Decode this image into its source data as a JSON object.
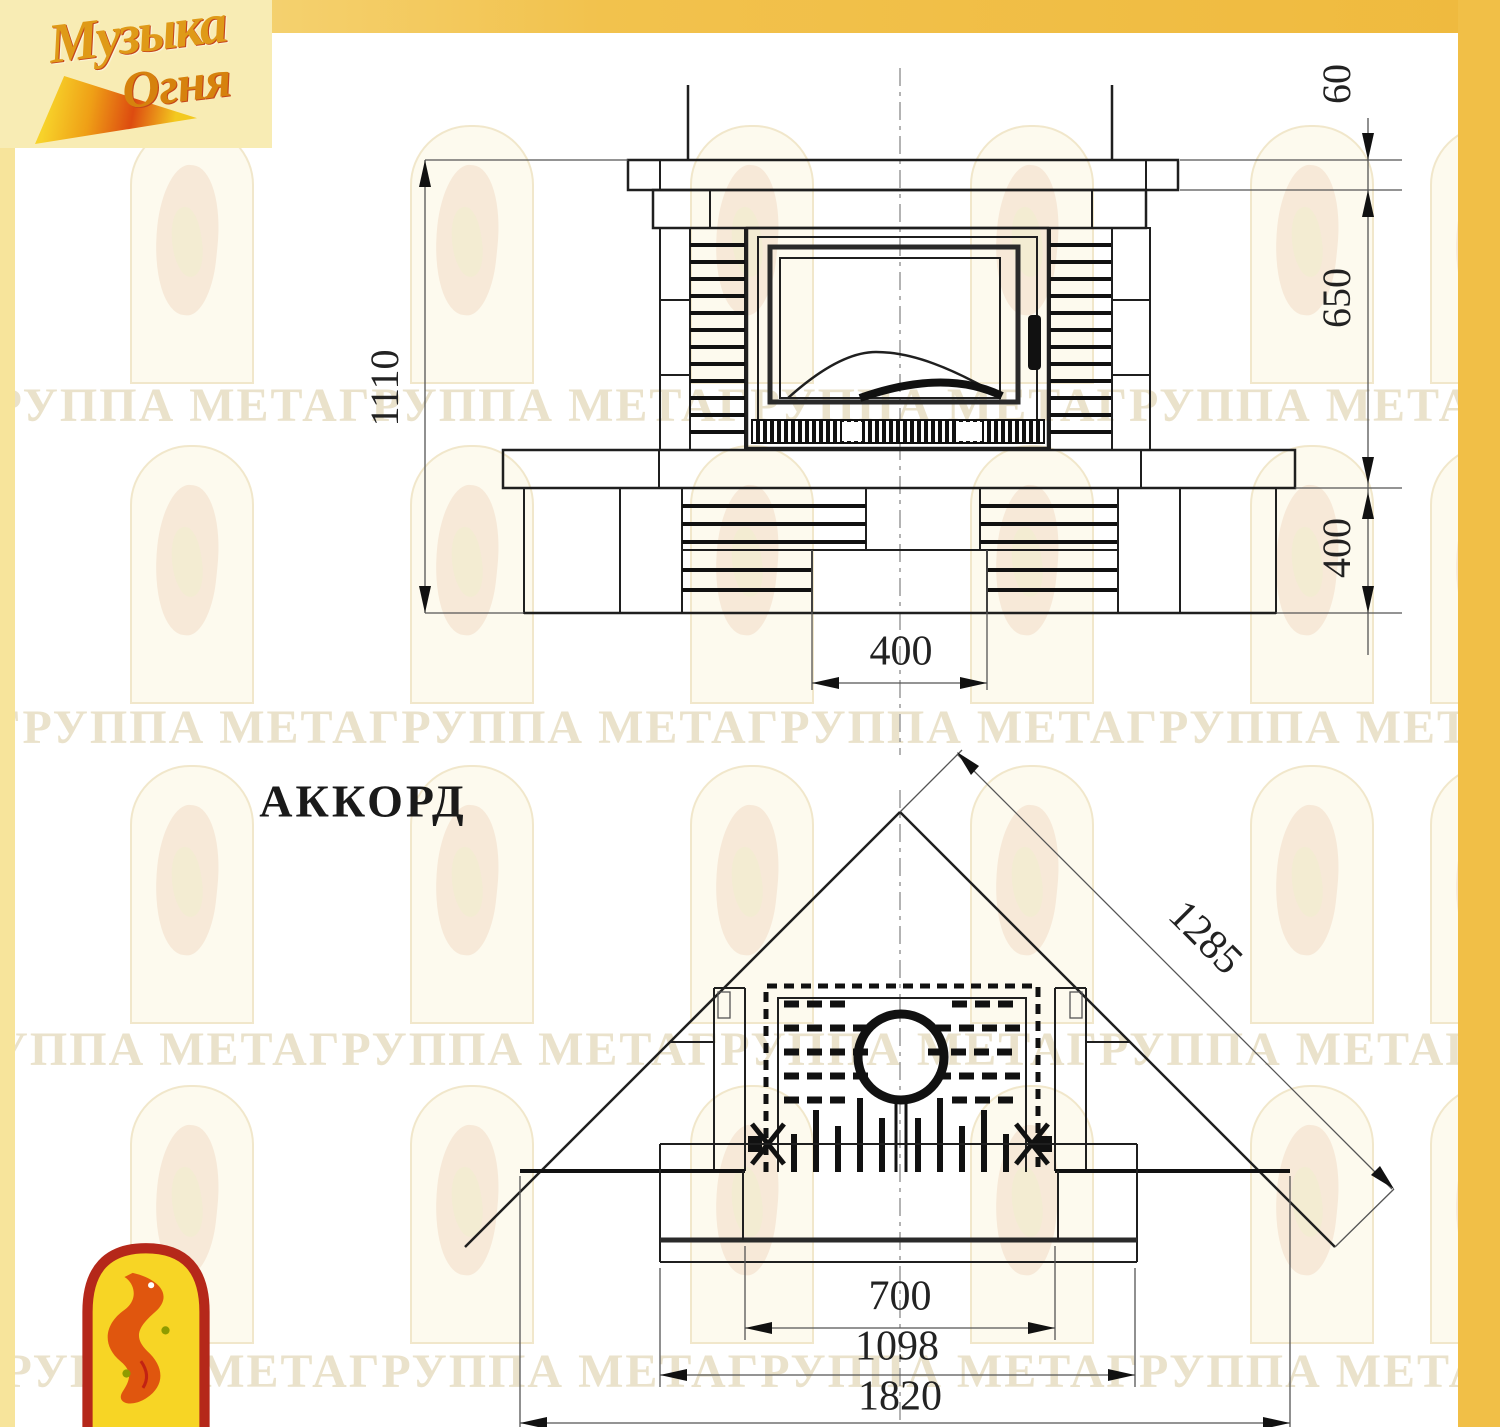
{
  "document": {
    "model_name": "АККОРД"
  },
  "brand_logo": {
    "word1": "Музыка",
    "word2": "Огня"
  },
  "watermark": {
    "row_text": "ГРУППА МЕТАГРУППА МЕТАГРУППА МЕТАГРУППА МЕТАГРУППА МЕТА"
  },
  "front_view": {
    "dimensions": {
      "total_height": "1110",
      "mantel_thickness": "60",
      "upper_height": "650",
      "base_height": "400",
      "niche_width": "400"
    }
  },
  "plan_view": {
    "dimensions": {
      "diagonal_depth": "1285",
      "opening_width": "700",
      "body_width": "1098",
      "total_width": "1820"
    }
  },
  "colors": {
    "band_gold": "#f2c24d",
    "panel_cream": "#f8ecb4",
    "logo_red": "#b5281a",
    "logo_yellow": "#f7d525",
    "flame_orange": "#e0560e",
    "line_dark": "#1f1f1f",
    "watermark_tint": "#eae2cb"
  }
}
